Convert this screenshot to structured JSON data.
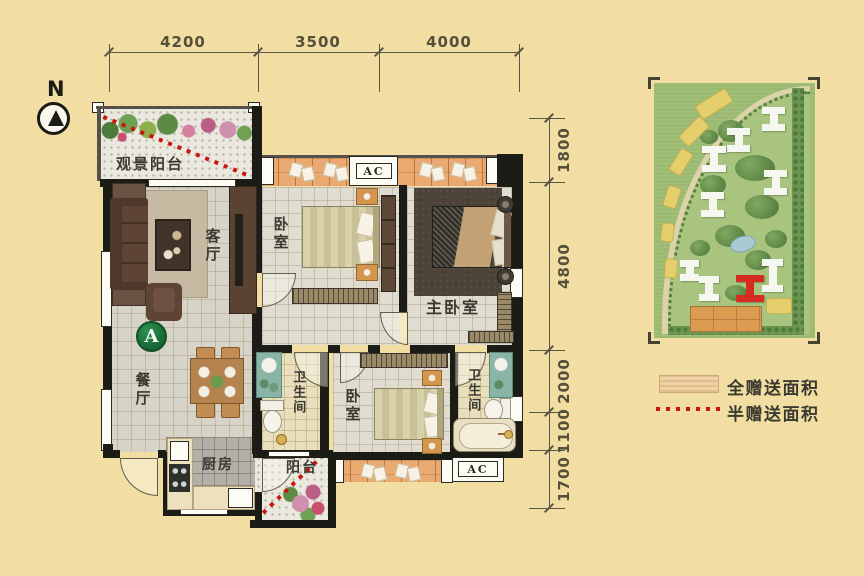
{
  "compass": {
    "label": "N"
  },
  "dims": {
    "top": [
      "4200",
      "3500",
      "4000"
    ],
    "right": [
      "1800",
      "4800",
      "2000",
      "1100",
      "1700"
    ]
  },
  "plan": {
    "badge": "A",
    "view_balcony": "观景阳台",
    "living": "客厅",
    "dining": "餐厅",
    "bedroom_top": "卧室",
    "master": "主卧室",
    "bath_mid": "卫生间",
    "bedroom_bottom": "卧室",
    "bath_right": "卫生间",
    "kitchen": "厨房",
    "balcony_bottom": "阳台",
    "ac_top": "AC",
    "ac_bottom": "AC"
  },
  "legend": {
    "items": [
      {
        "swatch": "wood-swatch",
        "label": "全赠送面积"
      },
      {
        "swatch": "red-dotted-line",
        "label": "半赠送面积"
      }
    ]
  },
  "colors": {
    "background": "#f2dea2",
    "wall": "#1c1c17",
    "gift_red": "#c8170e",
    "badge_green": "#176434",
    "balcony_wood": "#eaa970",
    "map_green": "#9cba72",
    "map_highlight_building": "#d62c22",
    "legend_swatch": "#eed2a8"
  }
}
